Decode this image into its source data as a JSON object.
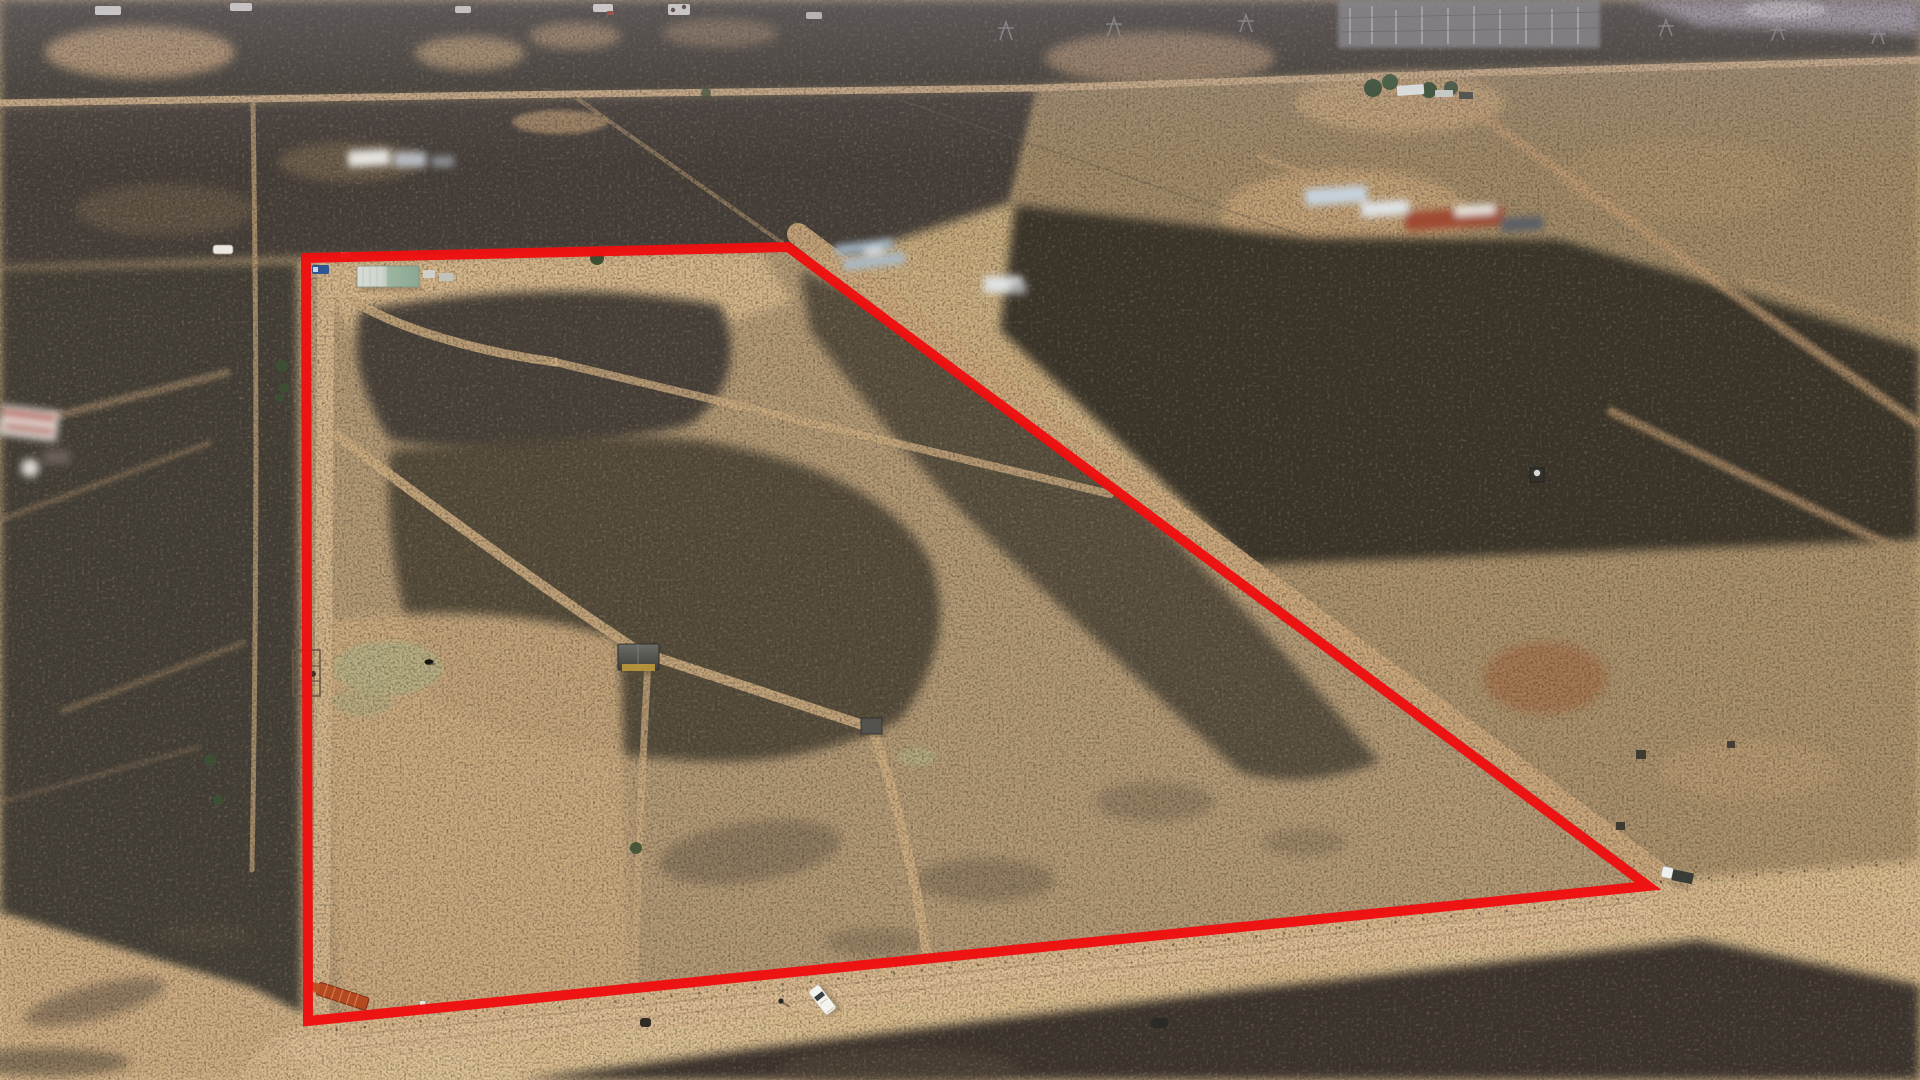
{
  "scene": {
    "kind": "aerial-drone-photograph",
    "subject": "arid rural land allotment with red property-boundary overlay",
    "palette": {
      "sand_light": "#dcbd92",
      "sand_road": "#d9b98e",
      "scrub_dark": "#3a342c",
      "scrub_mid": "#55493a",
      "mottle": "#a98f6d",
      "grass": "#b7b286",
      "haze": "#8d8794",
      "boundary_red": "#ee1010"
    }
  },
  "boundary": {
    "label": "property boundary outline",
    "color": "#ee1010",
    "stroke_width": "10",
    "points": "306,258 788,247 1648,886 308,1021"
  },
  "objects": {
    "main_shed": {
      "label": "farm shed with green and silver roof",
      "transform": "translate(357,265)"
    },
    "blue_truck": {
      "label": "blue pickup truck",
      "transform": "translate(312,265)"
    },
    "white_car": {
      "label": "white car at gate",
      "transform": "translate(340,252)"
    },
    "caravan": {
      "label": "white caravan outside west fence",
      "transform": "translate(213,245)"
    },
    "hay_shed": {
      "label": "dark-roofed hay shed",
      "transform": "translate(618,644)"
    },
    "field_shed": {
      "label": "small field shed",
      "transform": "translate(861,718)"
    },
    "stock_yards": {
      "label": "stock yards / pens",
      "transform": "translate(293,650)"
    },
    "cow": {
      "label": "grazing cow",
      "transform": "translate(425,659)"
    },
    "farm_trailer": {
      "label": "orange farm trailer at south-west corner",
      "transform": "translate(320,982) rotate(18)"
    },
    "white_ute": {
      "label": "white utility vehicle on road",
      "transform": "translate(808,992) rotate(-38)"
    },
    "person": {
      "label": "person standing near ute",
      "transform": "translate(781,1001)"
    },
    "dark_car": {
      "label": "dark vehicle on road",
      "transform": "translate(1151,1018)"
    },
    "corner_truck": {
      "label": "truck parked at east corner",
      "transform": "translate(1663,866) rotate(12)"
    },
    "water_tank": {
      "label": "neighbouring tank / hut",
      "transform": "translate(1530,468)"
    },
    "homestead": {
      "label": "neighbouring homestead with trees",
      "transform": "translate(1363,70)"
    },
    "substation": {
      "label": "electrical substation",
      "transform": "translate(1338,0)"
    },
    "house_blur": {
      "label": "blurred neighbouring house",
      "transform": "translate(0,402)"
    },
    "shed_blur_nw": {
      "label": "blurred buildings north-west",
      "transform": "translate(348,144)"
    },
    "panels_blur": {
      "label": "blurred panels east of gate",
      "transform": "translate(835,240)"
    },
    "building_blur": {
      "label": "blurred small building",
      "transform": "translate(984,276)"
    },
    "compound_blur": {
      "label": "blurred building compound east",
      "transform": "translate(1305,185)"
    }
  }
}
